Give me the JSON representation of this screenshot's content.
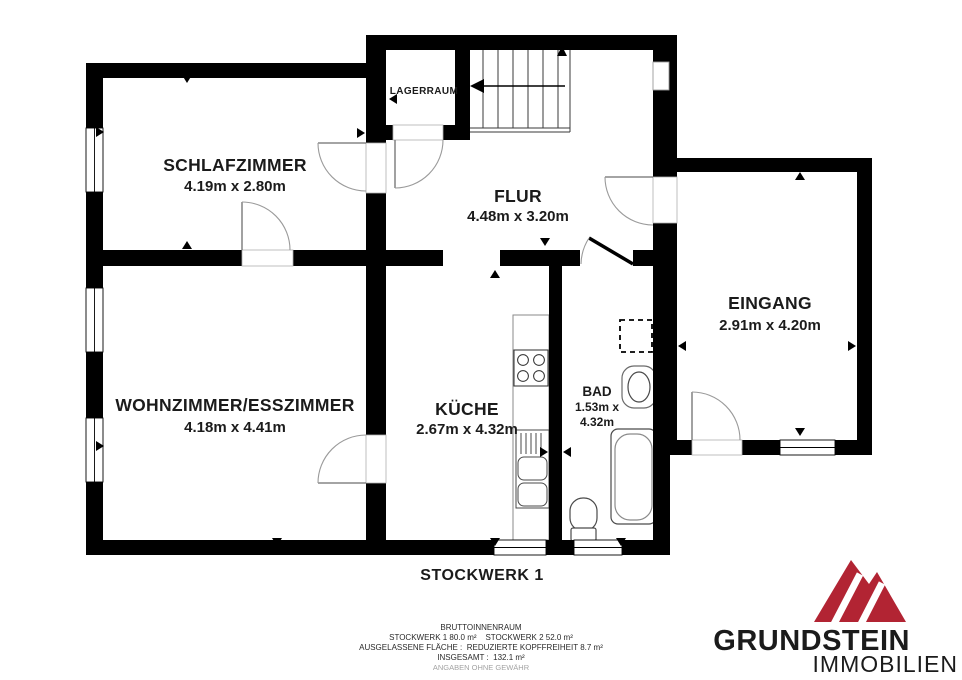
{
  "page": {
    "background": "#ffffff",
    "wall_color": "#000000"
  },
  "floorplan": {
    "floor_label": "STOCKWERK 1",
    "rooms": {
      "schlafzimmer": {
        "name": "SCHLAFZIMMER",
        "dims": "4.19m x 2.80m"
      },
      "flur": {
        "name": "FLUR",
        "dims": "4.48m x 3.20m"
      },
      "lagerraum": {
        "name": "LAGERRAUM"
      },
      "eingang": {
        "name": "EINGANG",
        "dims": "2.91m x 4.20m"
      },
      "wohnzimmer": {
        "name": "WOHNZIMMER/ESSZIMMER",
        "dims": "4.18m x 4.41m"
      },
      "kueche": {
        "name": "KÜCHE",
        "dims": "2.67m x 4.32m"
      },
      "bad": {
        "name": "BAD",
        "dims_line1": "1.53m x",
        "dims_line2": "4.32m"
      }
    }
  },
  "summary": {
    "line1": "BRUTTOINNENRAUM",
    "line2": "STOCKWERK 1 80.0 m²    STOCKWERK 2 52.0 m²",
    "line3": "AUSGELASSENE FLÄCHE :  REDUZIERTE KOPFFREIHEIT 8.7 m²",
    "line4": "INSGESAMT :  132.1 m²",
    "disclaimer": "ANGABEN OHNE GEWÄHR"
  },
  "logo": {
    "name": "GRUNDSTEIN",
    "subtitle": "IMMOBILIEN",
    "brand_red": "#b22433",
    "name_color": "#3b3b3a",
    "subtitle_color": "#8c8c8c"
  }
}
